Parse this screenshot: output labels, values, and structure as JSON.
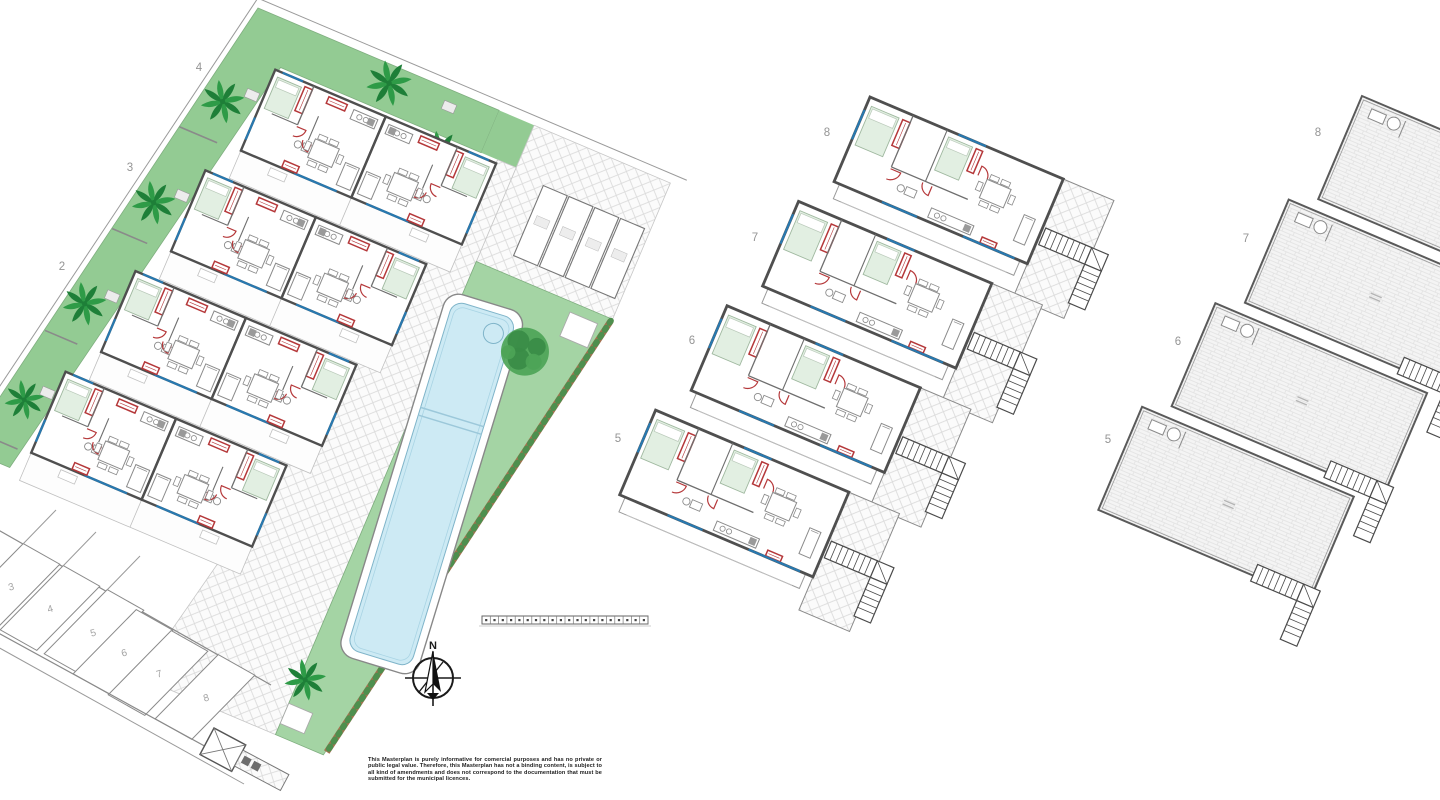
{
  "document": {
    "type": "residential development masterplan drawing"
  },
  "colors": {
    "garden": "#93cb93",
    "gardenLight": "#a4d4a4",
    "hedgeBrown": "#a2714f",
    "hedgeGreen": "#4e8f4e",
    "poolWater": "#cdeaf4",
    "poolEdge": "#7fb4c9",
    "poolStep": "#9cc8da",
    "wallDark": "#4f4f4f",
    "wallMid": "#777777",
    "lineLight": "#c2c2c2",
    "red": "#b5383a",
    "blue": "#2879b0",
    "bedFill": "#e2efe2",
    "bedLine": "#9fb89f",
    "paveLine": "#d6d6d6",
    "roofLine": "#dcdcdc",
    "labelGray": "#949494",
    "treeGreen": "#4da457",
    "treeDark": "#3a8c46",
    "palmGreen": "#2e9b47",
    "palmDark": "#1e7f38",
    "furn": "#8a8a8a",
    "stair": "#4a4a4a"
  },
  "plans": {
    "site": {
      "name": "Ground floor site plan",
      "unit_labels": [
        "4",
        "3",
        "2"
      ],
      "parking_labels": [
        "3",
        "4",
        "5",
        "6",
        "7",
        "8"
      ]
    },
    "first_floor": {
      "name": "First floor plan",
      "unit_labels": [
        "8",
        "7",
        "6",
        "5"
      ]
    },
    "roof": {
      "name": "Roof solarium plan",
      "unit_labels": [
        "8",
        "7",
        "6",
        "5"
      ]
    }
  },
  "compass": {
    "label": "N"
  },
  "disclaimer": {
    "text": "This Masterplan is purely informative for comercial purposes and has no private or public legal value. Therefore, this Masterplan has not a binding content, is subject to all kind of amendments and does not correspond to the documentation that must be submitted for the municipal licences."
  }
}
